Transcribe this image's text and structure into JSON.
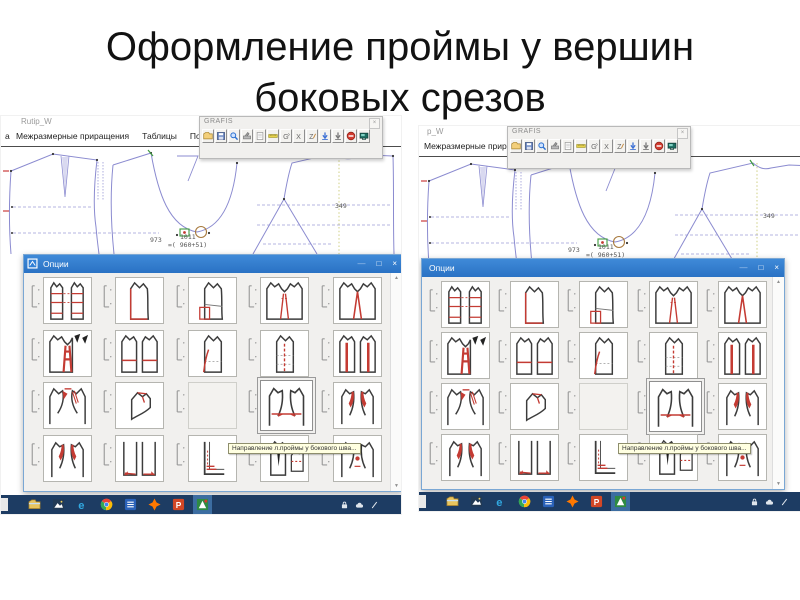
{
  "slide": {
    "title_line1": "Оформление проймы у вершин",
    "title_line2": "боковых срезов"
  },
  "windows": [
    {
      "title": "Rutip_W"
    },
    {
      "title": "p_W"
    }
  ],
  "app": {
    "menu_fragment": "а",
    "menu_items": [
      "Межразмерные приращения",
      "Таблицы",
      "Помощь"
    ],
    "toolbar": {
      "title": "GRAFIS",
      "icons": [
        "open-file",
        "save",
        "zoom",
        "plotter",
        "sheet",
        "ruler",
        "grading-g",
        "delete-x",
        "zigzag-z",
        "arrow-down-blue",
        "arrow-down-gray",
        "stop",
        "screen"
      ]
    },
    "measurements": {
      "left": "973",
      "center": "1011",
      "center_formula": "=( 960+51)",
      "right": "349"
    },
    "dialog": {
      "title": "Опции",
      "tooltip": "Направление л.проймы у бокового шва...",
      "grid": {
        "rows": [
          [
            {
              "sketch": "two-red-hlines"
            },
            {
              "sketch": "red-left-edge"
            },
            {
              "sketch": "waist-redbox"
            },
            {
              "sketch": "two-red-v"
            },
            {
              "sketch": "one-red-v"
            }
          ],
          [
            {
              "sketch": "thick-v-black"
            },
            {
              "sketch": "two-waistline"
            },
            {
              "sketch": "red-curve"
            },
            {
              "sketch": "dash-waist"
            },
            {
              "sketch": "two-redbars"
            }
          ],
          [
            {
              "sketch": "armhole-red"
            },
            {
              "sketch": "small-shoulder"
            },
            {
              "state": "empty"
            },
            {
              "sketch": "centerline",
              "state": "selected"
            },
            {
              "sketch": "armhole-corners"
            }
          ],
          [
            {
              "sketch": "armhole-corners"
            },
            {
              "sketch": "hem-marks"
            },
            {
              "sketch": "l-red"
            },
            {
              "sketch": "black-dart"
            },
            {
              "sketch": "red-dot"
            }
          ]
        ]
      }
    },
    "glyphs": {
      "minimize": "—",
      "maximize": "□",
      "close": "×",
      "scroll_up": "▲",
      "scroll_down": "▼"
    }
  },
  "taskbar": {
    "apps": [
      "explorer",
      "photos",
      "edge",
      "chrome",
      "office",
      "avast",
      "powerpoint",
      "grafis"
    ],
    "active": "grafis",
    "tray": [
      "lock",
      "cloud",
      "pen"
    ]
  },
  "colors": {
    "dialog_titlebar": "#2f7fd6",
    "taskbar": "#1d3c63",
    "pattern_line": "#8b8bd0",
    "sketch_red": "#c43b33"
  }
}
